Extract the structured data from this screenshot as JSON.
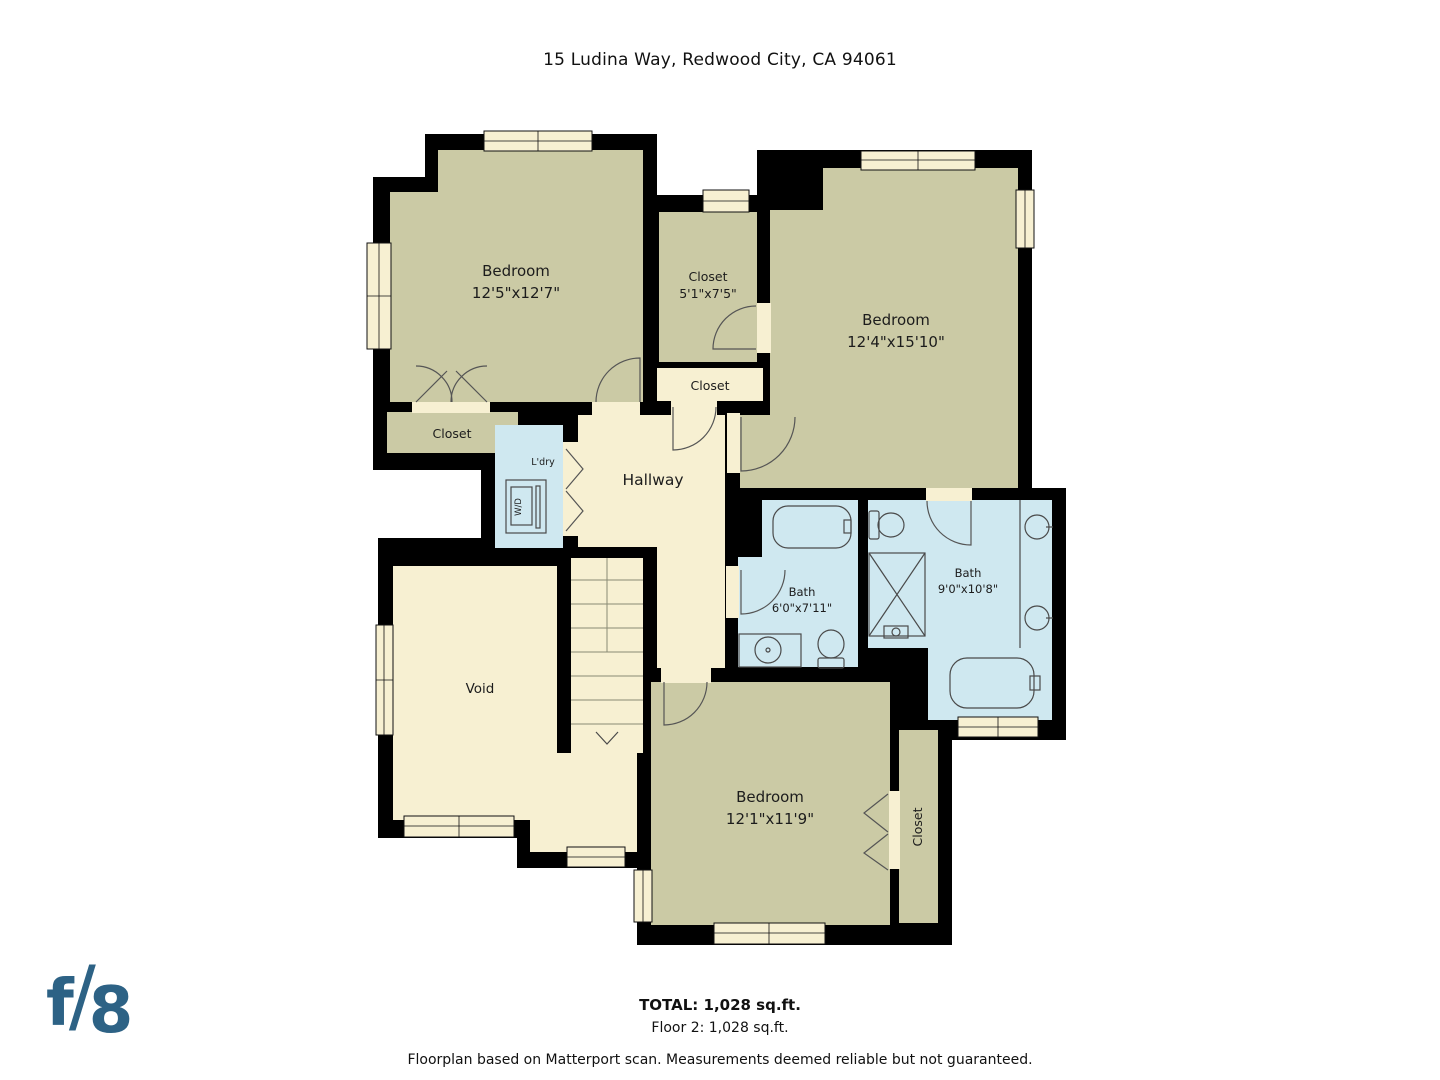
{
  "title": "15 Ludina Way, Redwood City, CA 94061",
  "rooms": {
    "bedroom_top_left": {
      "label": "Bedroom",
      "dims": "12'5\"x12'7\""
    },
    "closet_walkin": {
      "label": "Closet",
      "dims": "5'1\"x7'5\""
    },
    "bedroom_top_right": {
      "label": "Bedroom",
      "dims": "12'4\"x15'10\""
    },
    "closet_mid": {
      "label": "Closet"
    },
    "closet_bedroom1": {
      "label": "Closet"
    },
    "laundry": {
      "label": "L'dry",
      "appliance": "W/D"
    },
    "hallway": {
      "label": "Hallway"
    },
    "bath_small": {
      "label": "Bath",
      "dims": "6'0\"x7'11\""
    },
    "bath_large": {
      "label": "Bath",
      "dims": "9'0\"x10'8\""
    },
    "void": {
      "label": "Void"
    },
    "bedroom_bottom": {
      "label": "Bedroom",
      "dims": "12'1\"x11'9\""
    },
    "closet_bedroom3": {
      "label": "Closet"
    }
  },
  "footer": {
    "total": "TOTAL: 1,028 sq.ft.",
    "floor": "Floor 2: 1,028 sq.ft.",
    "disclaimer": "Floorplan based on Matterport scan. Measurements deemed reliable but not guaranteed."
  },
  "logo": {
    "f": "f",
    "slash": "/",
    "eight": "8"
  },
  "colors": {
    "room_tan": "#cbcaa5",
    "room_cream": "#f7f0d2",
    "room_blue": "#cfe8f0",
    "wall": "#000000",
    "logo_blue": "#2d6285",
    "background": "#ffffff"
  }
}
